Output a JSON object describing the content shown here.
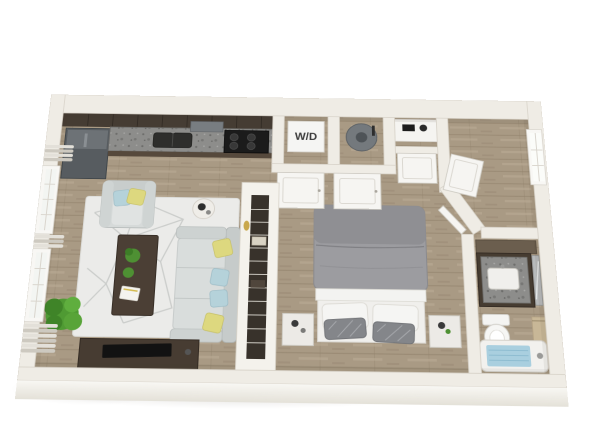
{
  "meta": {
    "type": "3d-floor-plan-rendering",
    "subject": "studio-apartment",
    "background": "#ffffff",
    "visible_text": [
      "W/D"
    ]
  },
  "labels": {
    "washer_dryer": "W/D"
  },
  "palette": {
    "background": "#ffffff",
    "wall": "#efece5",
    "wall_shadow": "#d7d3c9",
    "wood_floor": "#a99a84",
    "wood_plank_line": "#93826d",
    "kitchen_cabinet_dark": "#453c33",
    "granite_counter": "#8d8d8b",
    "appliance_black": "#1b1b1b",
    "fridge_gray": "#575c60",
    "sofa_gray": "#d9dddc",
    "pillow_yellow": "#ddd87f",
    "pillow_blue": "#b5d2da",
    "wood_furniture_dark": "#4b3f35",
    "rug_white": "#ebebe9",
    "rug_line": "#c9cbc9",
    "bed_duvet_gray": "#9c9ca0",
    "bed_sheet_white": "#f1f1ef",
    "plant_green": "#4f9a33",
    "water_heater_gray": "#74797d",
    "tub_water_blue": "#a9cfdf",
    "towel_tan": "#c8b797",
    "vanity_brown": "#463c31",
    "door_white": "#f6f5f2"
  },
  "rooms": {
    "kitchen": {
      "items": [
        "refrigerator",
        "upper-cabinets",
        "granite-countertop",
        "kitchen-sink",
        "range-hood",
        "stove-cooktop"
      ]
    },
    "laundry_closet": {
      "label": "W/D",
      "items": [
        "washer-dryer-unit",
        "bifold-door"
      ]
    },
    "utility_closet": {
      "items": [
        "water-heater",
        "bifold-door"
      ]
    },
    "linen_closet": {
      "items": [
        "shelf-items",
        "closet-door"
      ]
    },
    "entry_hall": {
      "items": [
        "entry-window",
        "coat-closet-door"
      ]
    },
    "living_room": {
      "items": [
        "window-left-upper",
        "window-left-lower",
        "window-blinds",
        "armchair",
        "sofa",
        "throw-pillows",
        "coffee-table",
        "table-plants",
        "book",
        "area-rug",
        "side-table",
        "tv-console",
        "tv",
        "corner-plant"
      ]
    },
    "wardrobe_partition": {
      "items": [
        "open-shelving",
        "basket",
        "decor-oval"
      ]
    },
    "bedroom": {
      "items": [
        "bed",
        "duvet",
        "sleeping-pillows",
        "accent-pillows",
        "nightstand-left",
        "nightstand-right",
        "potted-plant"
      ]
    },
    "bathroom": {
      "items": [
        "upper-cabinet",
        "vanity",
        "granite-vanity-top",
        "vanity-sink",
        "mirror",
        "toilet",
        "towel-bar",
        "bathtub",
        "bath-water",
        "bathroom-door"
      ]
    }
  }
}
